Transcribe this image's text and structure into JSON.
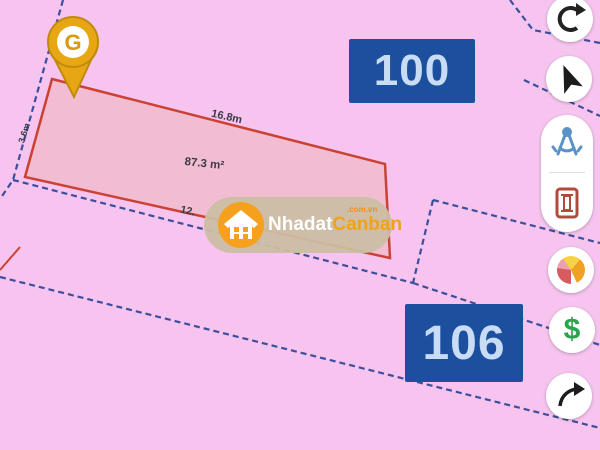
{
  "map": {
    "parcels": {
      "highlighted": {
        "area_label": "87.3 m²",
        "top_edge_label": "16.8m",
        "bottom_edge_label": "12.",
        "left_edge_label": "3.6m"
      },
      "numbers": [
        "100",
        "106"
      ]
    },
    "colors": {
      "background": "#f6c4ee",
      "parcel_fill": "#f2bdd2",
      "parcel_stroke": "#cb4133",
      "boundary_line": "#3d4f9c",
      "parcel_badge_bg": "#1d4f9f",
      "parcel_badge_text": "#c9dcf6",
      "measurement_text": "#3b3b47"
    }
  },
  "marker": {
    "logo_letter": "G",
    "pin_color": "#e7a715"
  },
  "watermark": {
    "brand_primary": "Nhadat",
    "brand_secondary": "Canban",
    "suffix": ".com.vn",
    "house_icon_color": "#f5a11d"
  },
  "toolbar": {
    "price_label": "$",
    "buttons": [
      {
        "icon": "rotate-icon"
      },
      {
        "icon": "navigation-icon"
      },
      {
        "icon": "measure-compass-icon"
      },
      {
        "icon": "planning-icon"
      },
      {
        "icon": "legend-pie-icon"
      },
      {
        "icon": "price-icon"
      },
      {
        "icon": "share-icon"
      }
    ]
  }
}
